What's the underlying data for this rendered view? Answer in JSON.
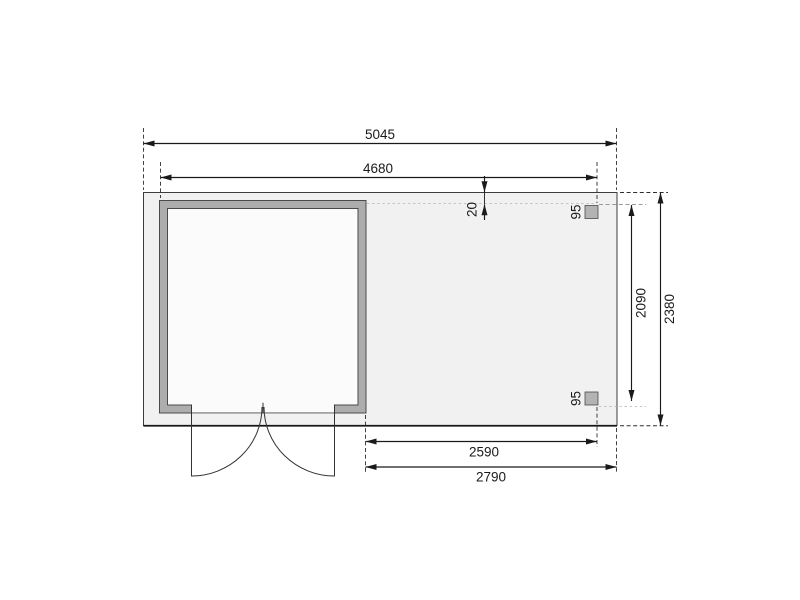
{
  "drawing": {
    "kind": "shed-floor-plan",
    "labels": {
      "overall_width": "5045",
      "roof_width": "4680",
      "roof_back_overhang": "20",
      "post_top_size": "95",
      "post_bottom_size": "95",
      "canopy_depth": "2090",
      "total_depth": "2380",
      "canopy_opening_width": "2590",
      "canopy_total_width": "2790"
    },
    "colors": {
      "floor_fill": "#f1f1f1",
      "wall_fill": "#adadad",
      "interior_fill": "#fbfbfb",
      "post_fill": "#b3b3b3",
      "line": "#1a1a1a",
      "canopy_dash": "#c4c4c4"
    }
  }
}
